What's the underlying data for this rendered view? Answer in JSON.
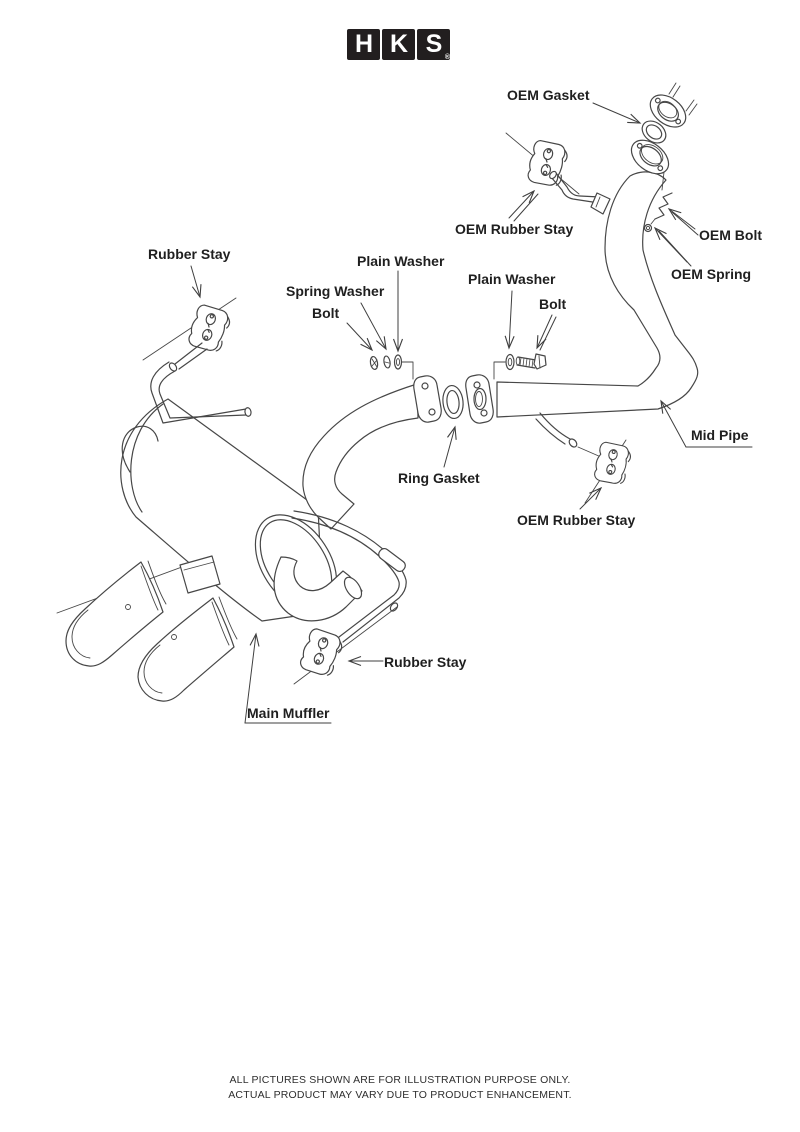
{
  "logo": {
    "h": "H",
    "k": "K",
    "s": "S",
    "reg": "®"
  },
  "labels": {
    "oem_gasket": "OEM Gasket",
    "oem_rubber_stay_top": "OEM Rubber Stay",
    "oem_bolt": "OEM Bolt",
    "oem_spring": "OEM Spring",
    "rubber_stay_left": "Rubber Stay",
    "plain_washer_left": "Plain Washer",
    "spring_washer": "Spring Washer",
    "bolt_left": "Bolt",
    "plain_washer_right": "Plain Washer",
    "bolt_right": "Bolt",
    "mid_pipe": "Mid Pipe",
    "ring_gasket": "Ring Gasket",
    "oem_rubber_stay_bottom": "OEM Rubber Stay",
    "rubber_stay_bottom": "Rubber Stay",
    "main_muffler": "Main Muffler"
  },
  "footer": {
    "line1": "ALL PICTURES SHOWN ARE FOR ILLUSTRATION PURPOSE ONLY.",
    "line2": "ACTUAL PRODUCT MAY VARY DUE TO PRODUCT ENHANCEMENT."
  },
  "colors": {
    "line": "#474747",
    "label": "#1f1f1f",
    "logo_bg": "#221e1f"
  }
}
